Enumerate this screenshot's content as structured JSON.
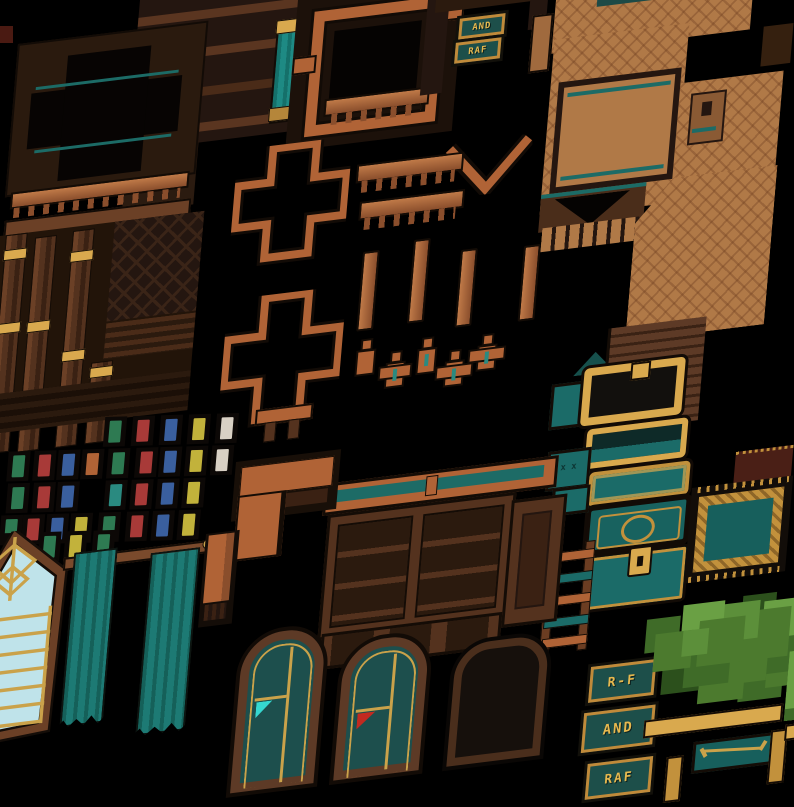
{
  "app": {
    "type": "pixel-art interior tileset sprite sheet",
    "background": "#000000"
  },
  "signs": {
    "top": [
      {
        "label": "AND"
      },
      {
        "label": "RAF"
      }
    ],
    "bottom": [
      {
        "label": "R-F"
      },
      {
        "label": "AND"
      },
      {
        "label": "RAF"
      }
    ]
  },
  "colors": {
    "wall_dark": "#241610",
    "wall_mid": "#54321e",
    "copper": "#b06336",
    "tan_floor": "#b07947",
    "gold": "#d9a94e",
    "teal": "#1d7a74",
    "teal_dark": "#1d4f4a",
    "glass_blue": "#bfe3ea",
    "foliage_green": "#4c7a2e",
    "flag_cyan": "#35d8d0",
    "flag_red": "#c22a20"
  },
  "books": {
    "palette": {
      "green": "#2e7a52",
      "red": "#a83a38",
      "blue": "#3a5f9e",
      "yellow": "#c2b23b",
      "white": "#d8d0c4",
      "bronze": "#b06336",
      "teal": "#2a8a80",
      "navy": "#2c3f7a"
    },
    "rows": [
      {
        "y": 6,
        "items": [
          {
            "x": 100,
            "c": "green"
          },
          {
            "x": 128,
            "c": "red"
          },
          {
            "x": 156,
            "c": "blue"
          },
          {
            "x": 184,
            "c": "yellow"
          },
          {
            "x": 212,
            "c": "white"
          }
        ]
      },
      {
        "y": 38,
        "items": [
          {
            "x": 6,
            "c": "green"
          },
          {
            "x": 32,
            "c": "red"
          },
          {
            "x": 56,
            "c": "blue"
          },
          {
            "x": 80,
            "c": "bronze"
          },
          {
            "x": 106,
            "c": "green"
          },
          {
            "x": 134,
            "c": "red"
          },
          {
            "x": 158,
            "c": "blue"
          },
          {
            "x": 184,
            "c": "yellow"
          },
          {
            "x": 210,
            "c": "white"
          }
        ]
      },
      {
        "y": 70,
        "items": [
          {
            "x": 8,
            "c": "green"
          },
          {
            "x": 34,
            "c": "red"
          },
          {
            "x": 58,
            "c": "blue"
          },
          {
            "x": 106,
            "c": "teal"
          },
          {
            "x": 132,
            "c": "red"
          },
          {
            "x": 158,
            "c": "blue"
          },
          {
            "x": 184,
            "c": "yellow"
          }
        ]
      },
      {
        "y": 102,
        "items": [
          {
            "x": 4,
            "c": "green"
          },
          {
            "x": 26,
            "c": "red"
          },
          {
            "x": 50,
            "c": "blue"
          },
          {
            "x": 74,
            "c": "yellow"
          },
          {
            "x": 102,
            "c": "green"
          },
          {
            "x": 130,
            "c": "red"
          },
          {
            "x": 156,
            "c": "blue"
          },
          {
            "x": 182,
            "c": "yellow"
          }
        ]
      },
      {
        "y": 120,
        "items": [
          {
            "x": 8,
            "c": "navy"
          },
          {
            "x": 44,
            "c": "green"
          },
          {
            "x": 70,
            "c": "yellow"
          },
          {
            "x": 98,
            "c": "green"
          }
        ]
      }
    ]
  }
}
